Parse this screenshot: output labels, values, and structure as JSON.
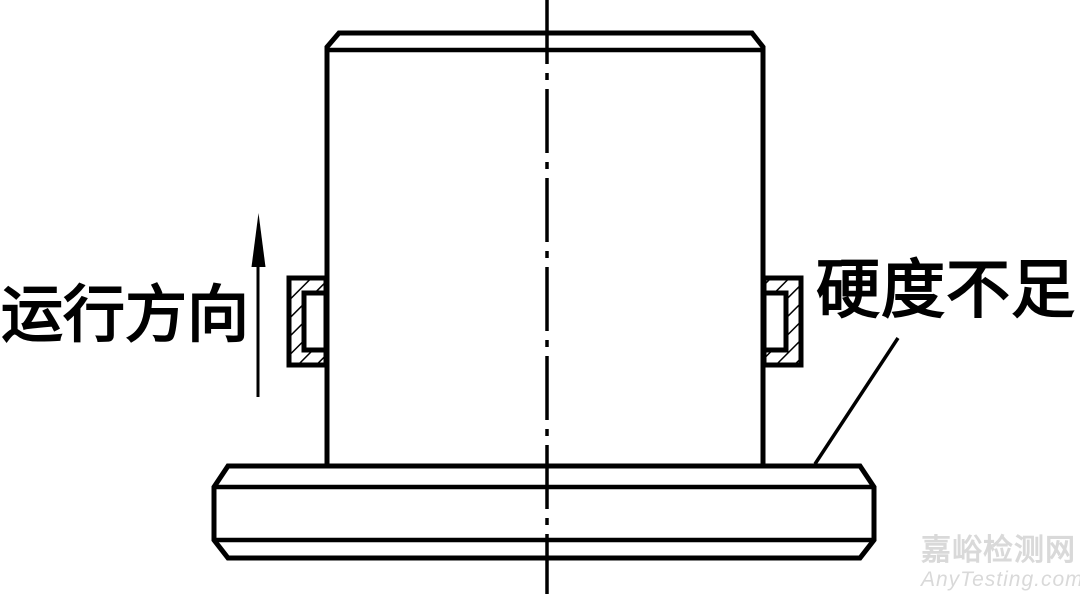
{
  "labels": {
    "run_direction": "运行方向",
    "hardness": "硬度不足"
  },
  "watermark": {
    "site_name_cn": "嘉峪检测网",
    "site_url": "AnyTesting.com"
  },
  "colors": {
    "line": "#000000",
    "background": "#ffffff",
    "watermark": "#d9d9d9"
  }
}
